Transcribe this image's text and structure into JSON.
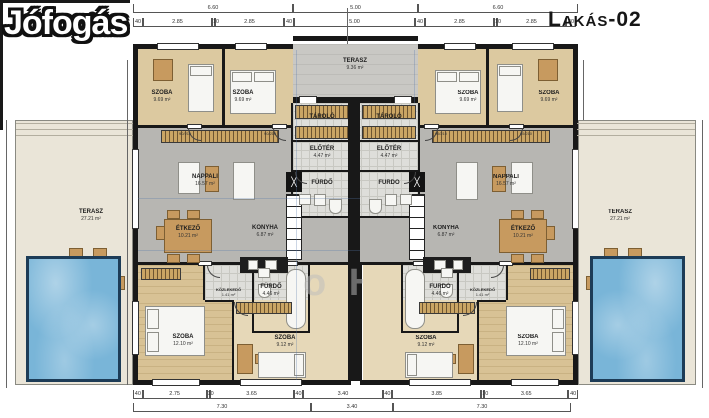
{
  "logo_watermark": "Jófogás",
  "units": {
    "left": "Lakás-01",
    "right": "Lakás-02"
  },
  "center_terrace": {
    "name": "TERASZ",
    "area": "9.36 m²"
  },
  "side_terrace": {
    "name": "TERASZ",
    "area": "27.21 m²"
  },
  "rooms": {
    "szoba_a": {
      "name": "SZOBA",
      "area": "9.69 m²"
    },
    "szoba_b": {
      "name": "SZOBA",
      "area": "9.69 m²"
    },
    "nappali": {
      "name": "NAPPALI",
      "area": "16.57 m²"
    },
    "etkezo": {
      "name": "ÉTKEZŐ",
      "area": "10.21 m²"
    },
    "konyha": {
      "name": "KONYHA",
      "area": "6.87 m²"
    },
    "eloter": {
      "name": "ELŐTÉR",
      "area": "4.47 m²"
    },
    "tarolo": {
      "name": "TÁROLÓ",
      "area": ""
    },
    "furdo_small": {
      "name": "FÜRDŐ",
      "area": ""
    },
    "furdo": {
      "name": "FÜRDŐ",
      "area": "4.46 m²"
    },
    "kozlekedo": {
      "name": "KÖZLEKEDŐ",
      "area": "1.41 m²"
    },
    "szoba_c": {
      "name": "SZOBA",
      "area": "12.10 m²"
    },
    "szoba_d": {
      "name": "SZOBA",
      "area": "9.12 m²"
    }
  },
  "door_labels": {
    "width": "90",
    "height": "210"
  },
  "dimensions": {
    "top_major": [
      "6.60",
      "5.00",
      "6.60"
    ],
    "top_minor": [
      "40",
      "2.85",
      "10",
      "2.85",
      "40",
      "5.00",
      "40",
      "2.85",
      "10",
      "2.85",
      "40"
    ],
    "bottom_minor": [
      "40",
      "2.75",
      "10",
      "3.65",
      "40",
      "3.40",
      "40",
      "3.85",
      "10",
      "3.65",
      "40"
    ],
    "bottom_major": [
      "7.30",
      "3.40",
      "7.30"
    ]
  },
  "watermark_fragment": "o H",
  "colors": {
    "wall": "#181818",
    "wood_floor": "#dcc9a0",
    "gray_floor": "#b7b6b2",
    "pool_water": "#79b5d8",
    "furniture_wood": "#c79a5f"
  }
}
